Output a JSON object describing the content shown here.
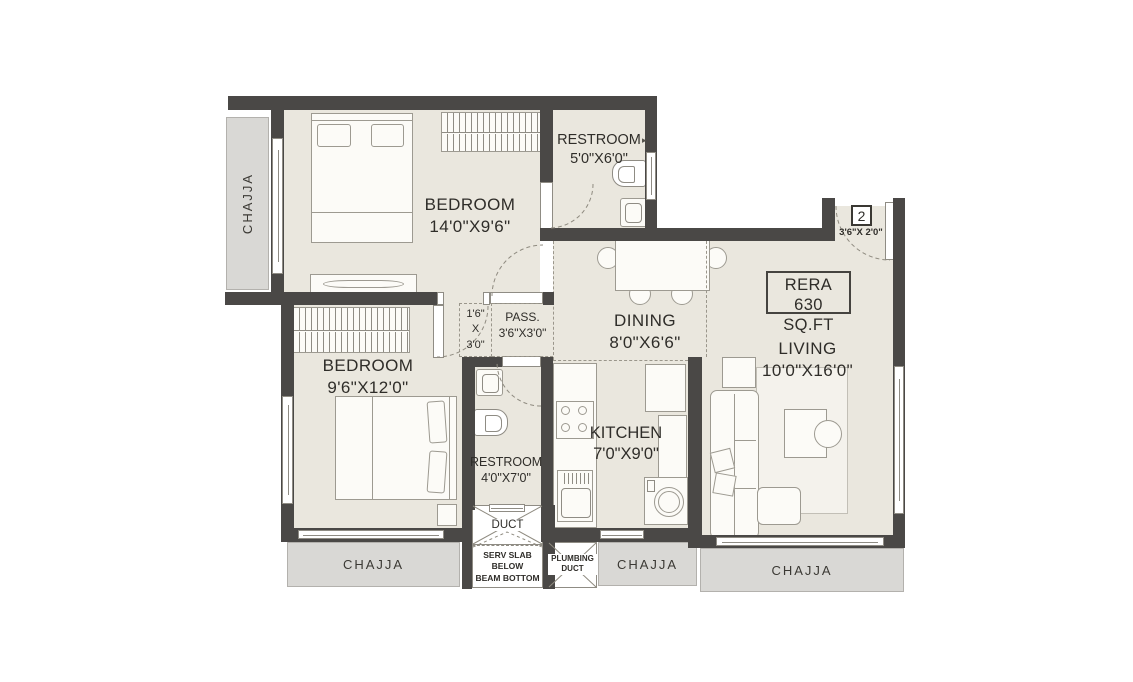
{
  "rooms": {
    "bedroom1": {
      "name": "BEDROOM",
      "dims": "14'0\"X9'6\""
    },
    "restroom1": {
      "name": "RESTROOM",
      "dims": "5'0\"X6'0\""
    },
    "dining": {
      "name": "DINING",
      "dims": "8'0\"X6'6\""
    },
    "living": {
      "name": "LIVING",
      "dims": "10'0\"X16'0\""
    },
    "bedroom2": {
      "name": "BEDROOM",
      "dims": "9'6\"X12'0\""
    },
    "restroom2": {
      "name": "RESTROOM",
      "dims": "4'0\"X7'0\""
    },
    "kitchen": {
      "name": "KITCHEN",
      "dims": "7'0\"X9'0\""
    },
    "passage": {
      "name": "PASS.",
      "dims": "3'6\"X3'0\""
    }
  },
  "vestibule": {
    "l1": "1'6\"",
    "l2": "X",
    "l3": "3'0\""
  },
  "entrance": {
    "number": "2",
    "dims": "3'6\"X 2'0\""
  },
  "rera": {
    "l1": "RERA",
    "l2": "630 SQ.FT"
  },
  "chajja_label": "CHAJJA",
  "duct": {
    "label": "DUCT",
    "serv_l1": "SERV SLAB",
    "serv_l2": "BELOW",
    "serv_l3": "BEAM BOTTOM"
  },
  "plumbing": {
    "l1": "PLUMBING",
    "l2": "DUCT"
  },
  "icons": {
    "vent_arrow": "▸"
  },
  "colors": {
    "wall": "#4a4846",
    "floor": "#eae7de",
    "chajja": "#d9d8d5",
    "line": "#8f8c84",
    "text": "#2f2d29"
  }
}
